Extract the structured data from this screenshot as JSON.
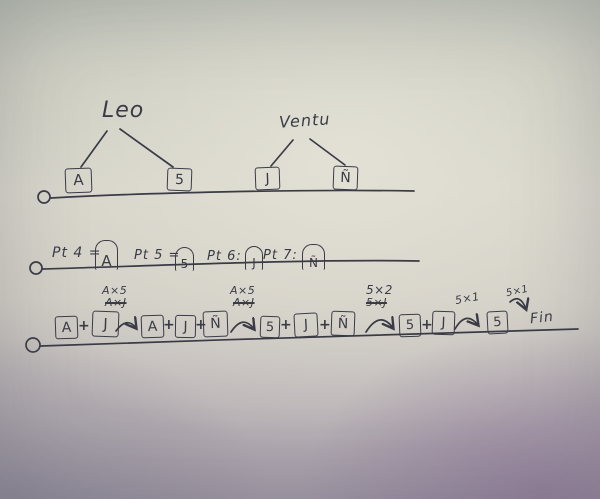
{
  "colors": {
    "ink": "#3b3b46",
    "paper_center": "#d3d1c7",
    "paper_top": "#b6bcb1",
    "paper_bottom_left": "#9e9ca6",
    "paper_bottom_right": "#97899f"
  },
  "tree": {
    "groups": [
      {
        "label": "Leo",
        "children": [
          "A",
          "5"
        ]
      },
      {
        "label": "Ventu",
        "children": [
          "J",
          "Ñ"
        ]
      }
    ]
  },
  "definitions": {
    "items": [
      {
        "prefix": "Pt 4 =",
        "value": "A"
      },
      {
        "prefix": "Pt 5 =",
        "value": "5"
      },
      {
        "prefix": "Pt 6:",
        "value": "J"
      },
      {
        "prefix": "Pt 7:",
        "value": "Ñ"
      }
    ]
  },
  "sequence": {
    "plus": "+",
    "terms": [
      "A",
      "J",
      "A",
      "J",
      "Ñ",
      "5",
      "J",
      "Ñ",
      "5",
      "J",
      "5"
    ],
    "annotations": [
      {
        "kept": "A×5",
        "crossed": "A×J"
      },
      {
        "kept": "A×5",
        "crossed": "A×J"
      },
      {
        "kept": "5×2",
        "crossed": "5×J"
      },
      {
        "kept": "5×1",
        "crossed": ""
      },
      {
        "kept": "5×1",
        "crossed": ""
      }
    ],
    "end_label": "Fin"
  }
}
